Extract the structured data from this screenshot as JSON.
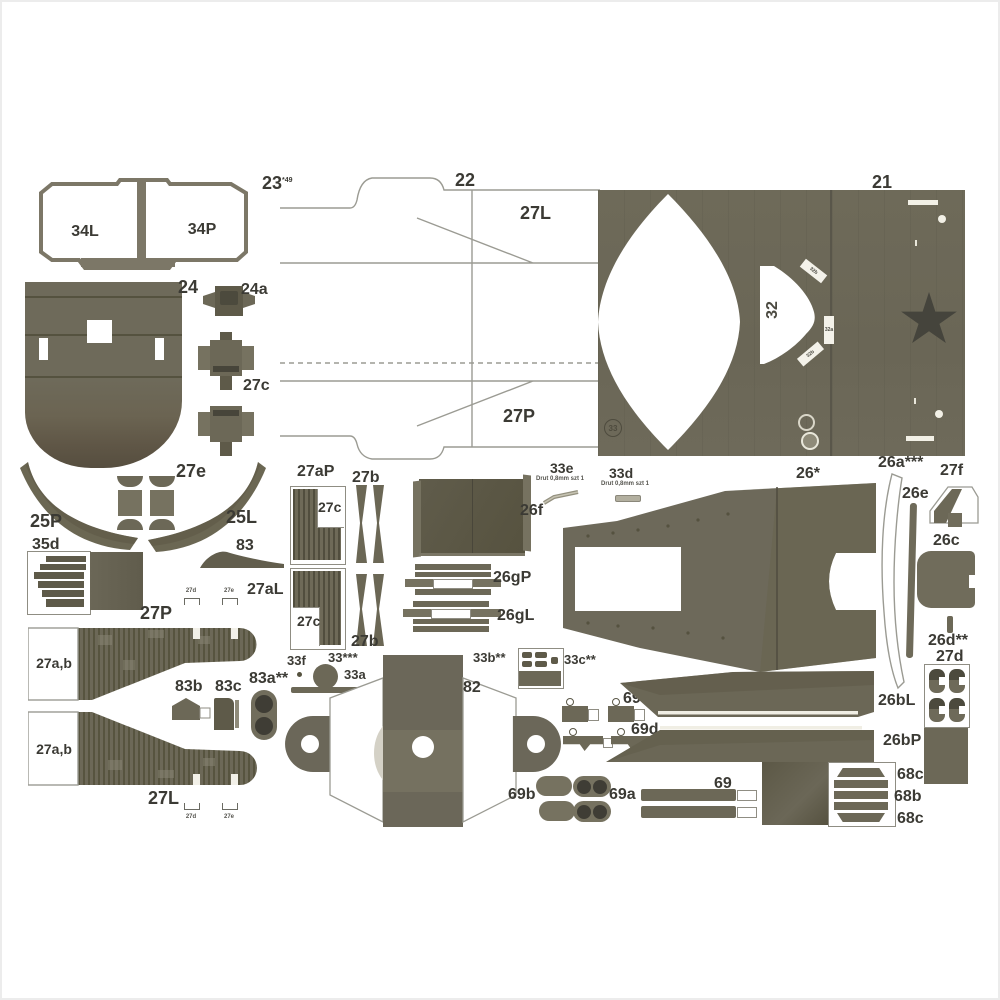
{
  "colors": {
    "olive": "#6c6857",
    "olive_dark": "#5e5a49",
    "olive_deep": "#4c4a3d",
    "olive_light": "#767260",
    "star": "#45443c",
    "ink": "#3b3a34",
    "outline": "#9b9b93"
  },
  "labels": {
    "top": {
      "p23": "23",
      "p23_sup": "*49",
      "p34L": "34L",
      "p34P": "34P",
      "p22": "22",
      "p27L": "27L",
      "p27P": "27P",
      "p21": "21",
      "p32": "32",
      "p33_mark": "33",
      "tag_top": "32b",
      "tag_mid": "32a",
      "tag_bot": "32b"
    },
    "mid": {
      "p24": "24",
      "p24a": "24a",
      "p27c": "27c",
      "p25P": "25P",
      "p27e": "27e",
      "p25L": "25L",
      "p35d": "35d",
      "p83": "83"
    },
    "center": {
      "p27aP": "27aP",
      "p27c_top": "27c",
      "p27b_top": "27b",
      "p26f": "26f",
      "p33e": "33e",
      "p33e_note": "Drut 0,8mm szt 1",
      "p33d": "33d",
      "p33d_note": "Drut 0,8mm szt 1",
      "p26star": "26*",
      "p27aL": "27aL",
      "p27c_bot": "27c",
      "p27b_bot": "27b",
      "p26gP": "26gP",
      "p26gL": "26gL"
    },
    "right": {
      "p26a": "26a***",
      "p27f": "27f",
      "p26e": "26e",
      "p26c": "26c",
      "p26d": "26d**",
      "p27d": "27d"
    },
    "lower": {
      "p27P": "27P",
      "p27ab_top": "27a,b",
      "p27ab_bot": "27a,b",
      "p27L": "27L",
      "mk_top_1": "27d",
      "mk_top_2": "27e",
      "mk_bot_1": "27d",
      "mk_bot_2": "27e",
      "p33f": "33f",
      "p33ast": "33***",
      "p33a": "33a",
      "p83b": "83b",
      "p83c": "83c",
      "p83a": "83a**",
      "p82": "82",
      "p33b": "33b**",
      "p33c": "33c**"
    },
    "bottom": {
      "p69c": "69c",
      "p69d": "69d",
      "p26bL": "26bL",
      "p26bP": "26bP",
      "p69b": "69b",
      "p69a": "69a",
      "p69": "69",
      "p68c_a": "68c",
      "p68b": "68b",
      "p68c_b": "68c"
    }
  }
}
